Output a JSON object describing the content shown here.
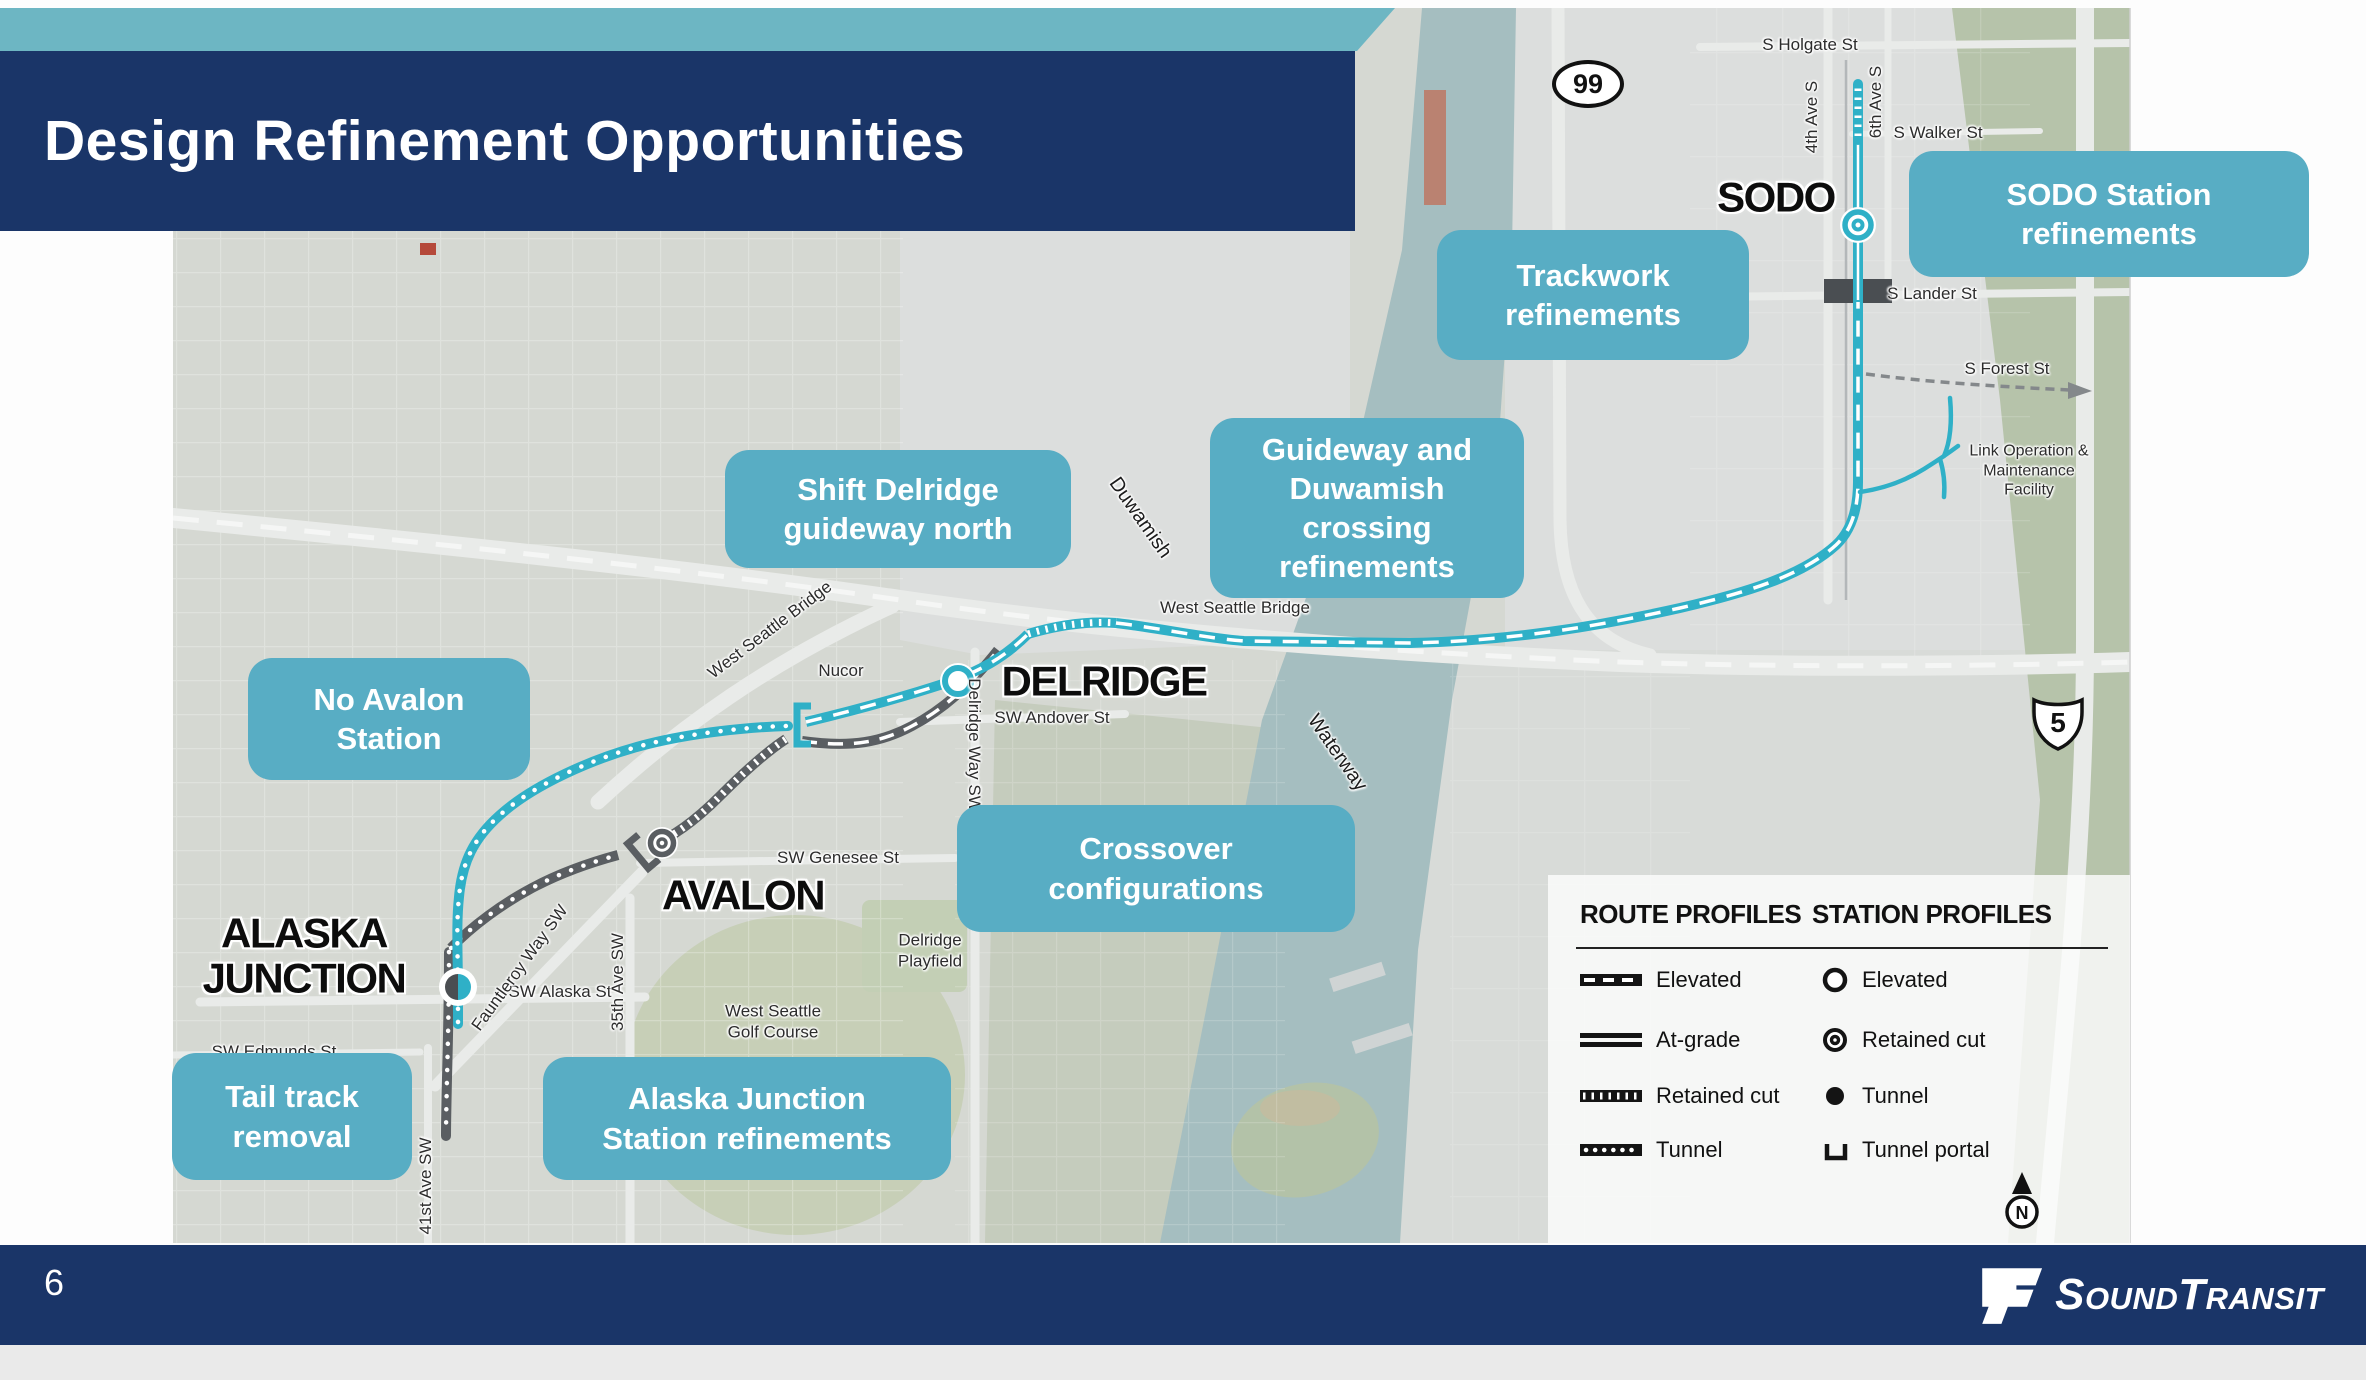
{
  "slide": {
    "title": "Design Refinement Opportunities",
    "page_number": "6"
  },
  "footer": {
    "logo": {
      "name": "SoundTransit",
      "part1": "S",
      "part2": "OUND",
      "part3": "T",
      "part4": "RANSIT"
    }
  },
  "legend": {
    "route_title": "ROUTE PROFILES",
    "station_title": "STATION PROFILES",
    "route_items": [
      {
        "style": "elevated",
        "label": "Elevated"
      },
      {
        "style": "at-grade",
        "label": "At-grade"
      },
      {
        "style": "retained-cut",
        "label": "Retained cut"
      },
      {
        "style": "tunnel",
        "label": "Tunnel"
      }
    ],
    "station_items": [
      {
        "style": "elevated",
        "label": "Elevated"
      },
      {
        "style": "retained-cut",
        "label": "Retained cut"
      },
      {
        "style": "tunnel",
        "label": "Tunnel"
      },
      {
        "style": "tunnel-portal",
        "label": "Tunnel portal"
      }
    ],
    "north_label": "N"
  },
  "map": {
    "stations": [
      {
        "name": "SODO",
        "profile": "retained-cut"
      },
      {
        "name": "DELRIDGE",
        "profile": "elevated"
      },
      {
        "name": "AVALON",
        "profile": "retained-cut"
      },
      {
        "name": "ALASKA JUNCTION",
        "profile": "tunnel",
        "lines": [
          "ALASKA",
          "JUNCTION"
        ]
      }
    ],
    "callouts": [
      {
        "id": "sodo-station",
        "lines": [
          "SODO Station",
          "refinements"
        ]
      },
      {
        "id": "trackwork",
        "lines": [
          "Trackwork",
          "refinements"
        ]
      },
      {
        "id": "guideway-duwamish",
        "lines": [
          "Guideway and",
          "Duwamish crossing",
          "refinements"
        ]
      },
      {
        "id": "shift-delridge",
        "lines": [
          "Shift Delridge",
          "guideway north"
        ]
      },
      {
        "id": "no-avalon",
        "lines": [
          "No Avalon",
          "Station"
        ]
      },
      {
        "id": "crossover",
        "lines": [
          "Crossover",
          "configurations"
        ]
      },
      {
        "id": "tail-track",
        "lines": [
          "Tail track",
          "removal"
        ]
      },
      {
        "id": "alaska-junction",
        "lines": [
          "Alaska Junction",
          "Station refinements"
        ]
      }
    ],
    "street_labels": [
      {
        "text": "S Holgate St"
      },
      {
        "text": "4th Ave S"
      },
      {
        "text": "6th Ave S"
      },
      {
        "text": "S Walker St"
      },
      {
        "text": "S Lander St"
      },
      {
        "text": "S Forest St"
      },
      {
        "text": "West Seattle Bridge"
      },
      {
        "text": "West Seattle Bridge"
      },
      {
        "text": "SW Andover St"
      },
      {
        "text": "Delridge Way SW"
      },
      {
        "text": "SW Genesee St"
      },
      {
        "text": "SW Alaska St"
      },
      {
        "text": "Fauntleroy Way SW"
      },
      {
        "text": "35th Ave SW"
      },
      {
        "text": "41st Ave SW"
      },
      {
        "text": "SW Edmunds St"
      }
    ],
    "place_labels": [
      {
        "lines": [
          "Nucor"
        ]
      },
      {
        "lines": [
          "Duwamish"
        ]
      },
      {
        "lines": [
          "Waterway"
        ]
      },
      {
        "lines": [
          "Delridge",
          "Playfield"
        ]
      },
      {
        "lines": [
          "West Seattle",
          "Golf Course"
        ]
      },
      {
        "lines": [
          "Link Operation &",
          "Maintenance",
          "Facility"
        ]
      }
    ],
    "shields": {
      "sr99": "99",
      "i5": "5"
    }
  },
  "colors": {
    "navy": "#1a3568",
    "callout_teal": "#58adc4",
    "strip_teal": "#6db6c3",
    "route_teal": "#2fb0c7",
    "route_gray": "#5a5e62",
    "water": "#a5bec0"
  }
}
